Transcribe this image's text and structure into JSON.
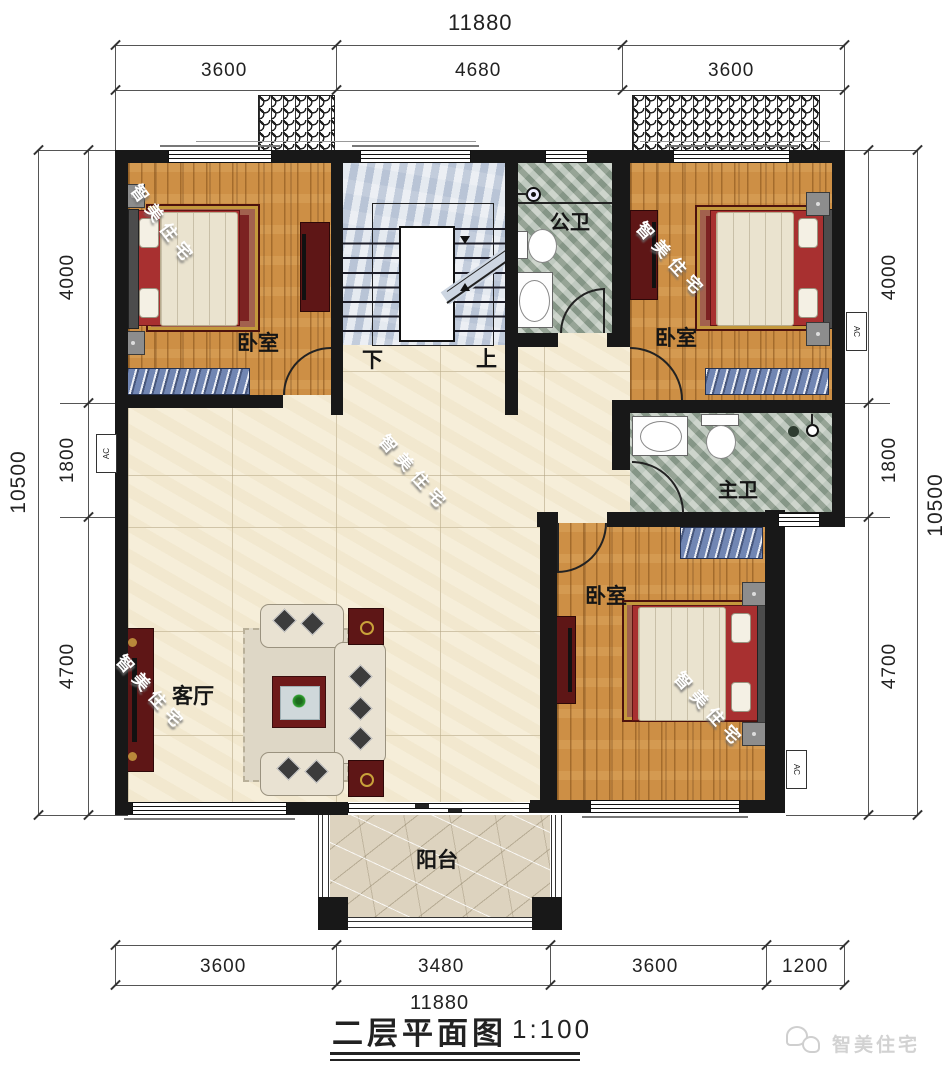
{
  "meta": {
    "title": "二层平面图",
    "scale": "1:100"
  },
  "brand": {
    "watermark": "智美住宅",
    "logo": "智美住宅"
  },
  "labels": {
    "bedroom": "卧室",
    "public_bath": "公卫",
    "master_bath": "主卫",
    "living": "客厅",
    "balcony": "阳台",
    "stairs_down": "下",
    "stairs_up": "上",
    "ac": "AC"
  },
  "dimensions": {
    "top": {
      "total": "11880",
      "segments": [
        "3600",
        "4680",
        "3600"
      ]
    },
    "bottom": {
      "total": "11880",
      "segments": [
        "3600",
        "3480",
        "3600",
        "1200"
      ]
    },
    "left": {
      "total": "10500",
      "segments": [
        "4000",
        "1800",
        "4700"
      ]
    },
    "right": {
      "total": "10500",
      "segments": [
        "4000",
        "1800",
        "4700"
      ]
    }
  }
}
